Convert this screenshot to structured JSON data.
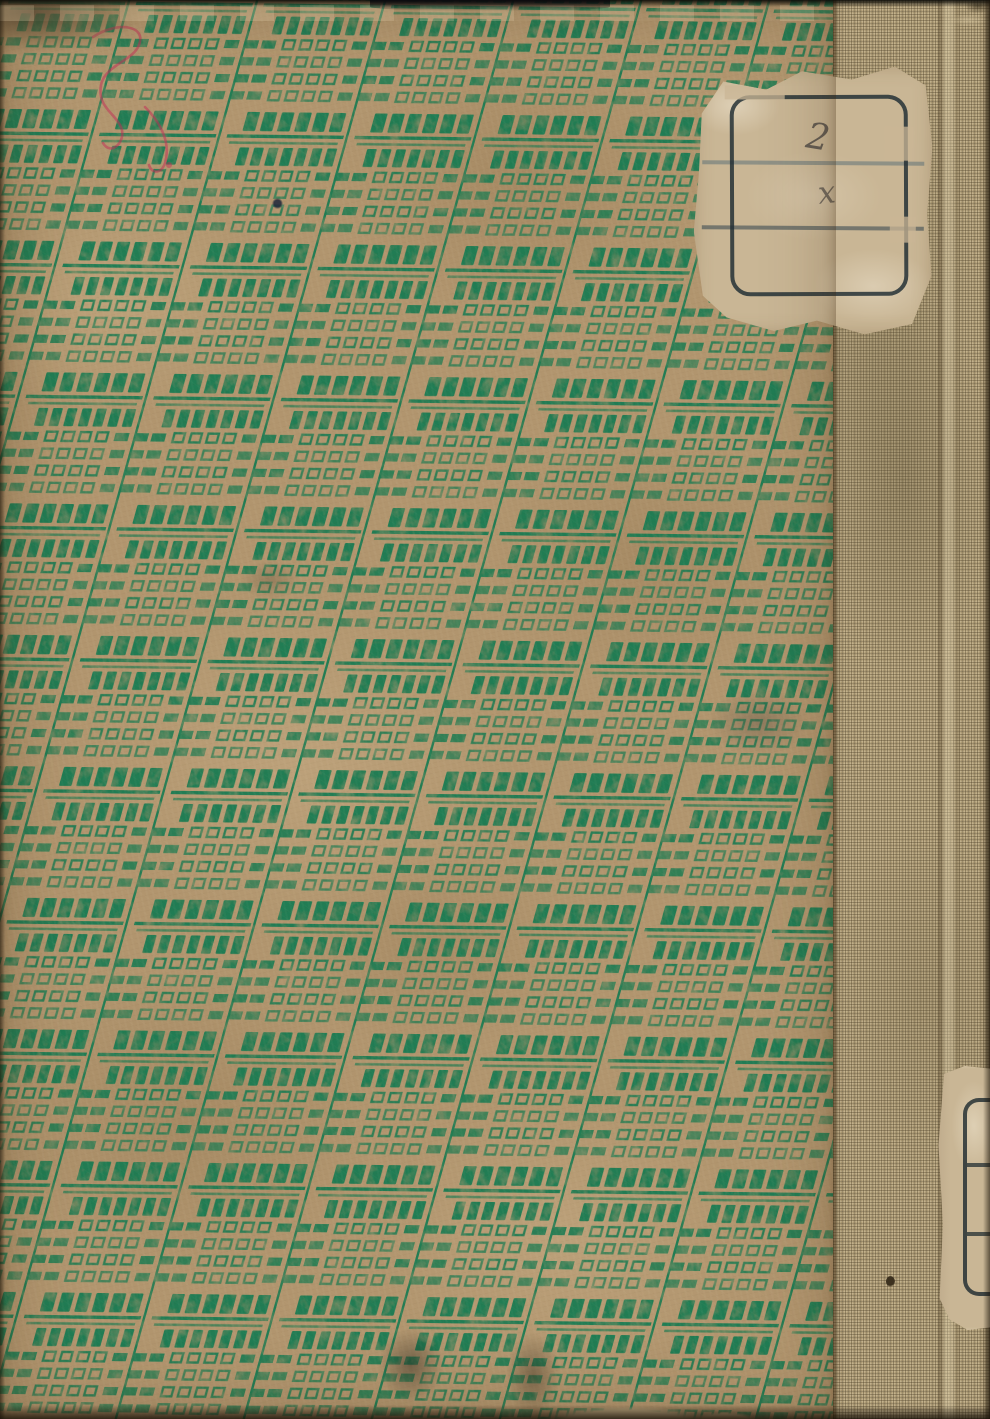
{
  "scene": {
    "kind": "scanned back cover of a worn hardcover book",
    "paper_pattern": "diagonal lattice of green printed blocks: bars, dashes and small open squares",
    "spine": "tan woven cloth strip along right edge"
  },
  "colors": {
    "pattern_green": "#1f7b52",
    "paper_tan": "#b1956e",
    "cloth": "#ab9872",
    "label_paper": "#c9b695",
    "stamp_ink": "#1e2c32",
    "ruled_line_blue": "#4a6470",
    "red_pencil": "#c22c55"
  },
  "top_label": {
    "handwriting_top": "2",
    "handwriting_bottom": "x"
  },
  "edge_label": {}
}
